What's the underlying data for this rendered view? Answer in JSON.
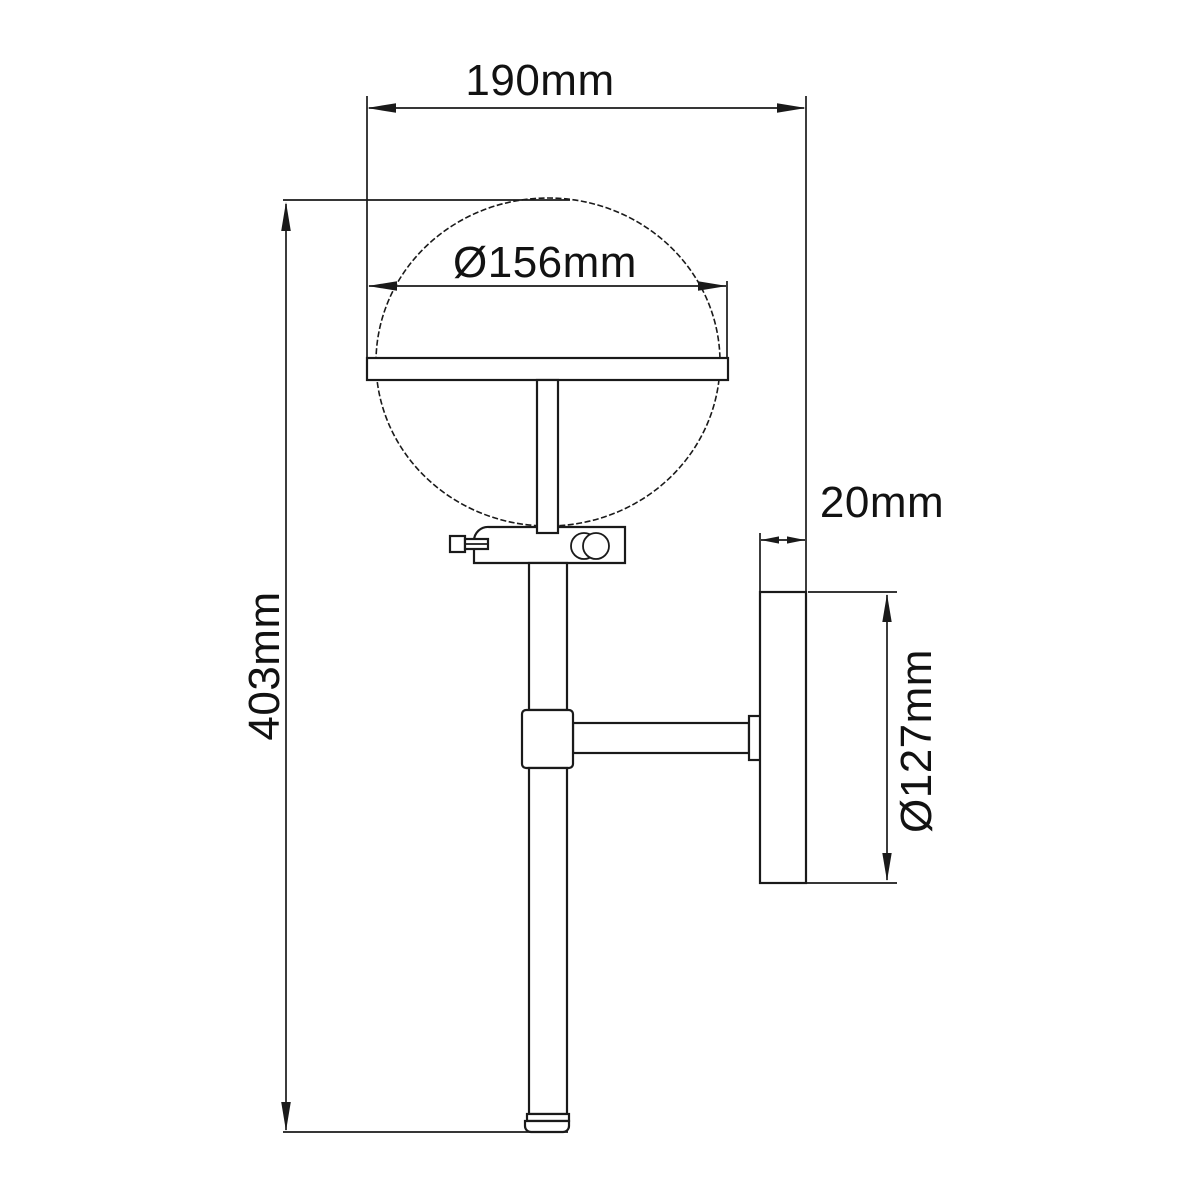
{
  "diagram": {
    "type": "technical-drawing",
    "subject": "wall sconce light fixture - side elevation with dimensions",
    "colors": {
      "background": "#ffffff",
      "line": "#1a1a1a",
      "text": "#121212"
    },
    "dimensions": {
      "overall_width": "190mm",
      "globe_diameter": "Ø156mm",
      "overall_height": "403mm",
      "backplate_depth": "20mm",
      "backplate_diameter": "Ø127mm"
    }
  }
}
